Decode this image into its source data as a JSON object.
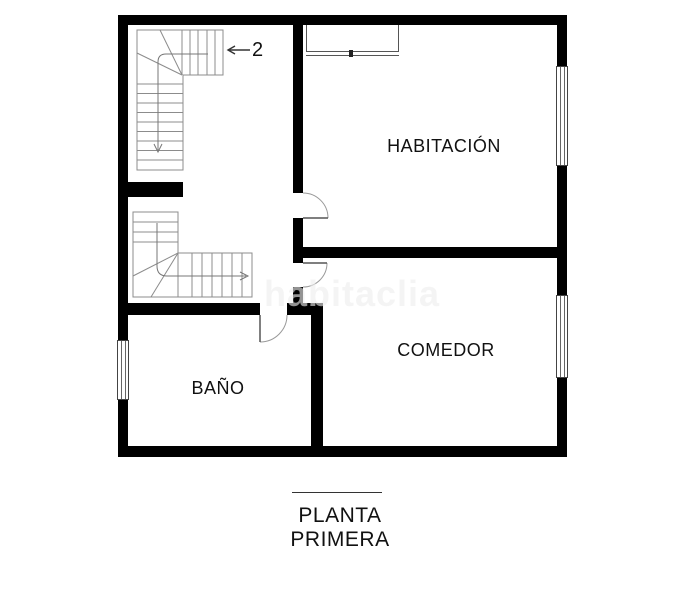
{
  "plan": {
    "type": "floor-plan",
    "rooms": [
      {
        "id": "habitacion",
        "label": "HABITACIÓN"
      },
      {
        "id": "comedor",
        "label": "COMEDOR"
      },
      {
        "id": "bano",
        "label": "BAÑO"
      }
    ],
    "stairs": {
      "upper_stair_direction_label": "2"
    },
    "caption": {
      "line1": "PLANTA",
      "line2": "PRIMERA"
    },
    "watermark": "habitaclia",
    "colors": {
      "wall": "#000000",
      "stair_line": "#8c8c8c",
      "door_line": "#888888",
      "label_text": "#111111",
      "watermark_text": "#eeeeee",
      "background": "#ffffff"
    }
  }
}
